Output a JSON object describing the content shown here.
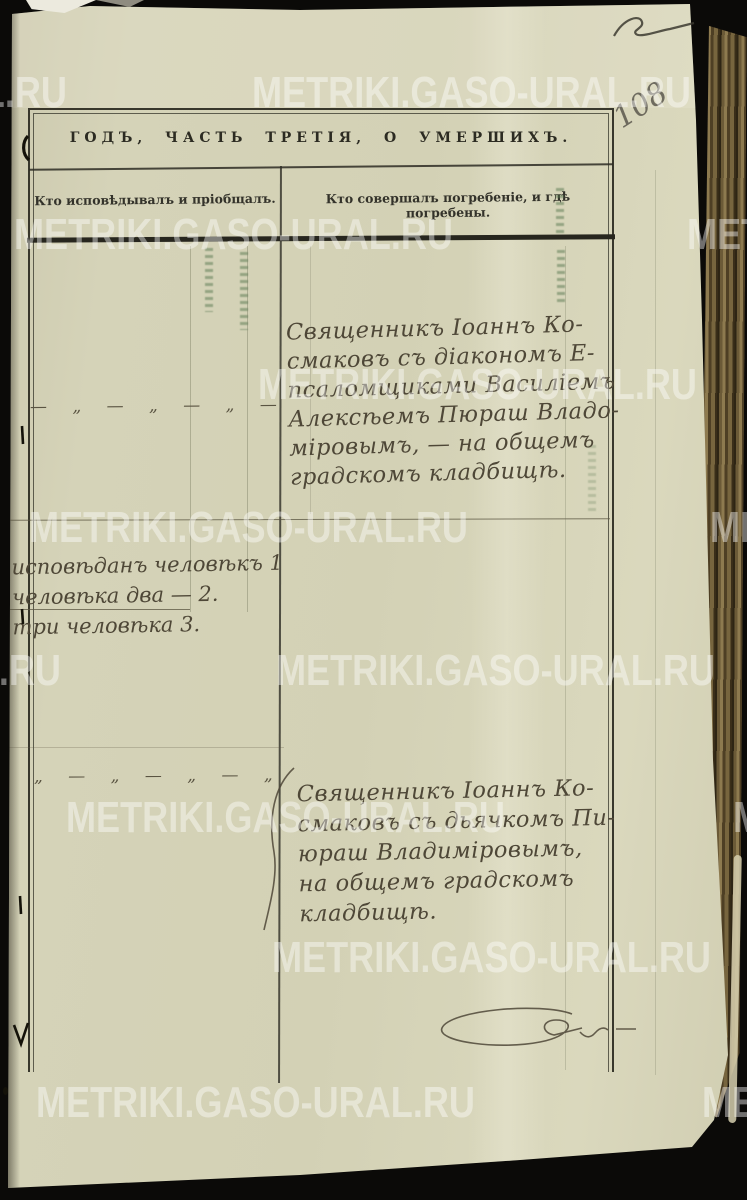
{
  "photo": {
    "watermark_text": "METRIKI.GASO-URAL.RU",
    "page_number_pencil": "108"
  },
  "register": {
    "title": "ГОДЪ, ЧАСТЬ ТРЕТІЯ, О УМЕРШИХЪ.",
    "columns": {
      "confession": "Кто исповѣдывалъ и пріобщалъ.",
      "burial": "Кто совершалъ погребеніе, и гдѣ погребены."
    }
  },
  "handwriting": {
    "ditto_row_1": "— „ — „ — „ —",
    "ditto_row_2": "„ — „ — „ — „",
    "tally_lines": [
      "исповѣданъ человѣкъ 1",
      "человѣка два — 2.",
      "три человѣка 3."
    ],
    "burial_entry_1": [
      "Священникъ Іоаннъ Ко-",
      "смаковъ съ діакономъ Е-",
      "псаломщиками Василіемъ",
      "Алексѣемъ Пюраш Владо-",
      "міровымъ, — на общемъ",
      "градскомъ кладбищѣ."
    ],
    "burial_entry_2": [
      "Священникъ Іоаннъ Ко-",
      "смаковъ съ дьячкомъ Пи-",
      "юраш Владиміровымъ,",
      "на общемъ градскомъ",
      "кладбищѣ."
    ]
  },
  "colors": {
    "paper": "#d4d2b6",
    "background": "#0b0a08",
    "ink": "#4e4737",
    "print": "#2c2b22",
    "watermark": "rgba(255,255,255,0.42)",
    "fore_edge_brown": "#6b5a37"
  }
}
